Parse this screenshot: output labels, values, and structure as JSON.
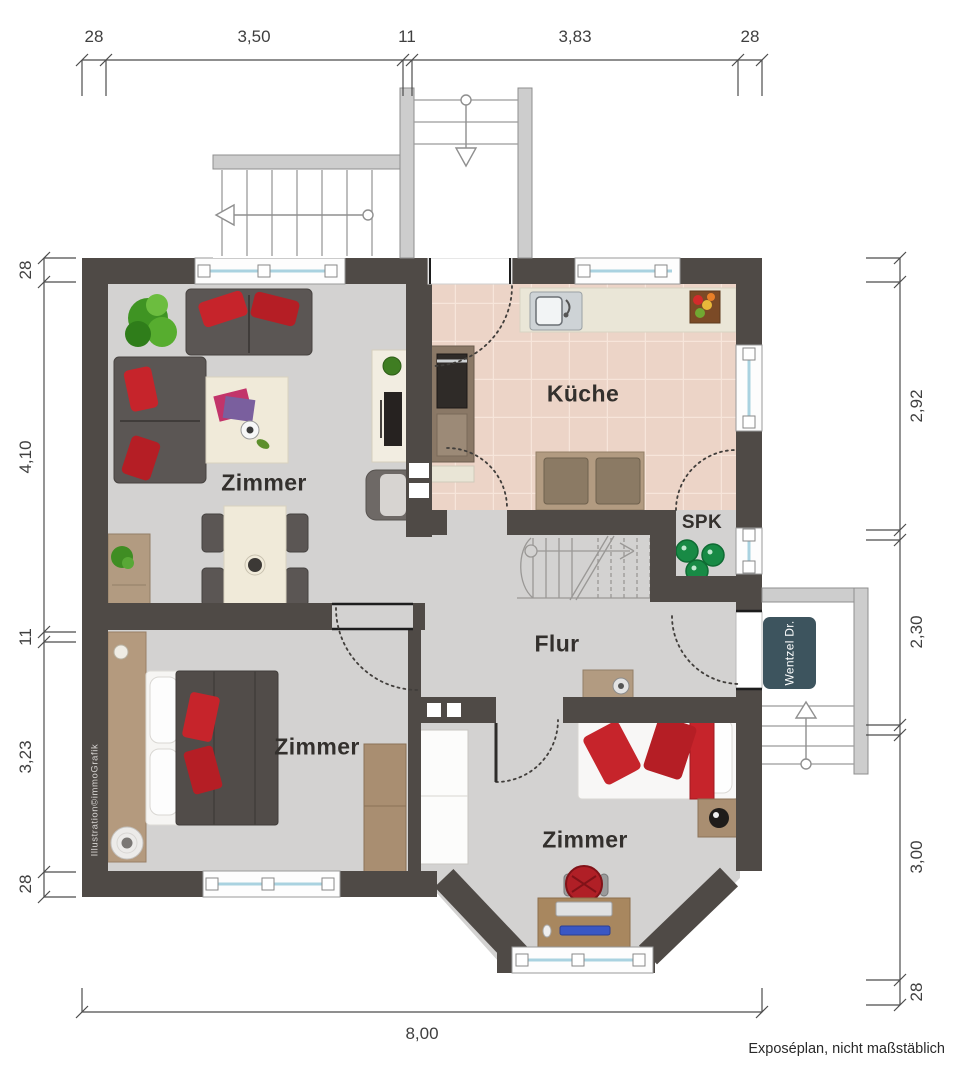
{
  "rooms": {
    "living_label": "Zimmer",
    "kitchen_label": "Küche",
    "pantry_label": "SPK",
    "hall_label": "Flur",
    "bedroom_left_label": "Zimmer",
    "bedroom_right_label": "Zimmer"
  },
  "dimensions": {
    "top": [
      "28",
      "3,50",
      "11",
      "3,83",
      "28"
    ],
    "left": [
      "28",
      "4,10",
      "11",
      "3,23",
      "28"
    ],
    "right": [
      "2,92",
      "2,30",
      "3,00",
      "28"
    ],
    "bottom": [
      "8,00"
    ]
  },
  "annotations": {
    "street_sign": "Wentzel Dr.",
    "credit": "Illustration©immoGrafik",
    "disclaimer": "Exposéplan, nicht maßstäblich"
  },
  "colors": {
    "wall": "#4f4a46",
    "floor": "#d3d2d1",
    "kitchen_floor": "#ecd4c7",
    "accent_red": "#c6242b",
    "plant_green": "#4aa32a",
    "window_glass": "#a9d2e0",
    "sign_bg": "#3d545e"
  }
}
